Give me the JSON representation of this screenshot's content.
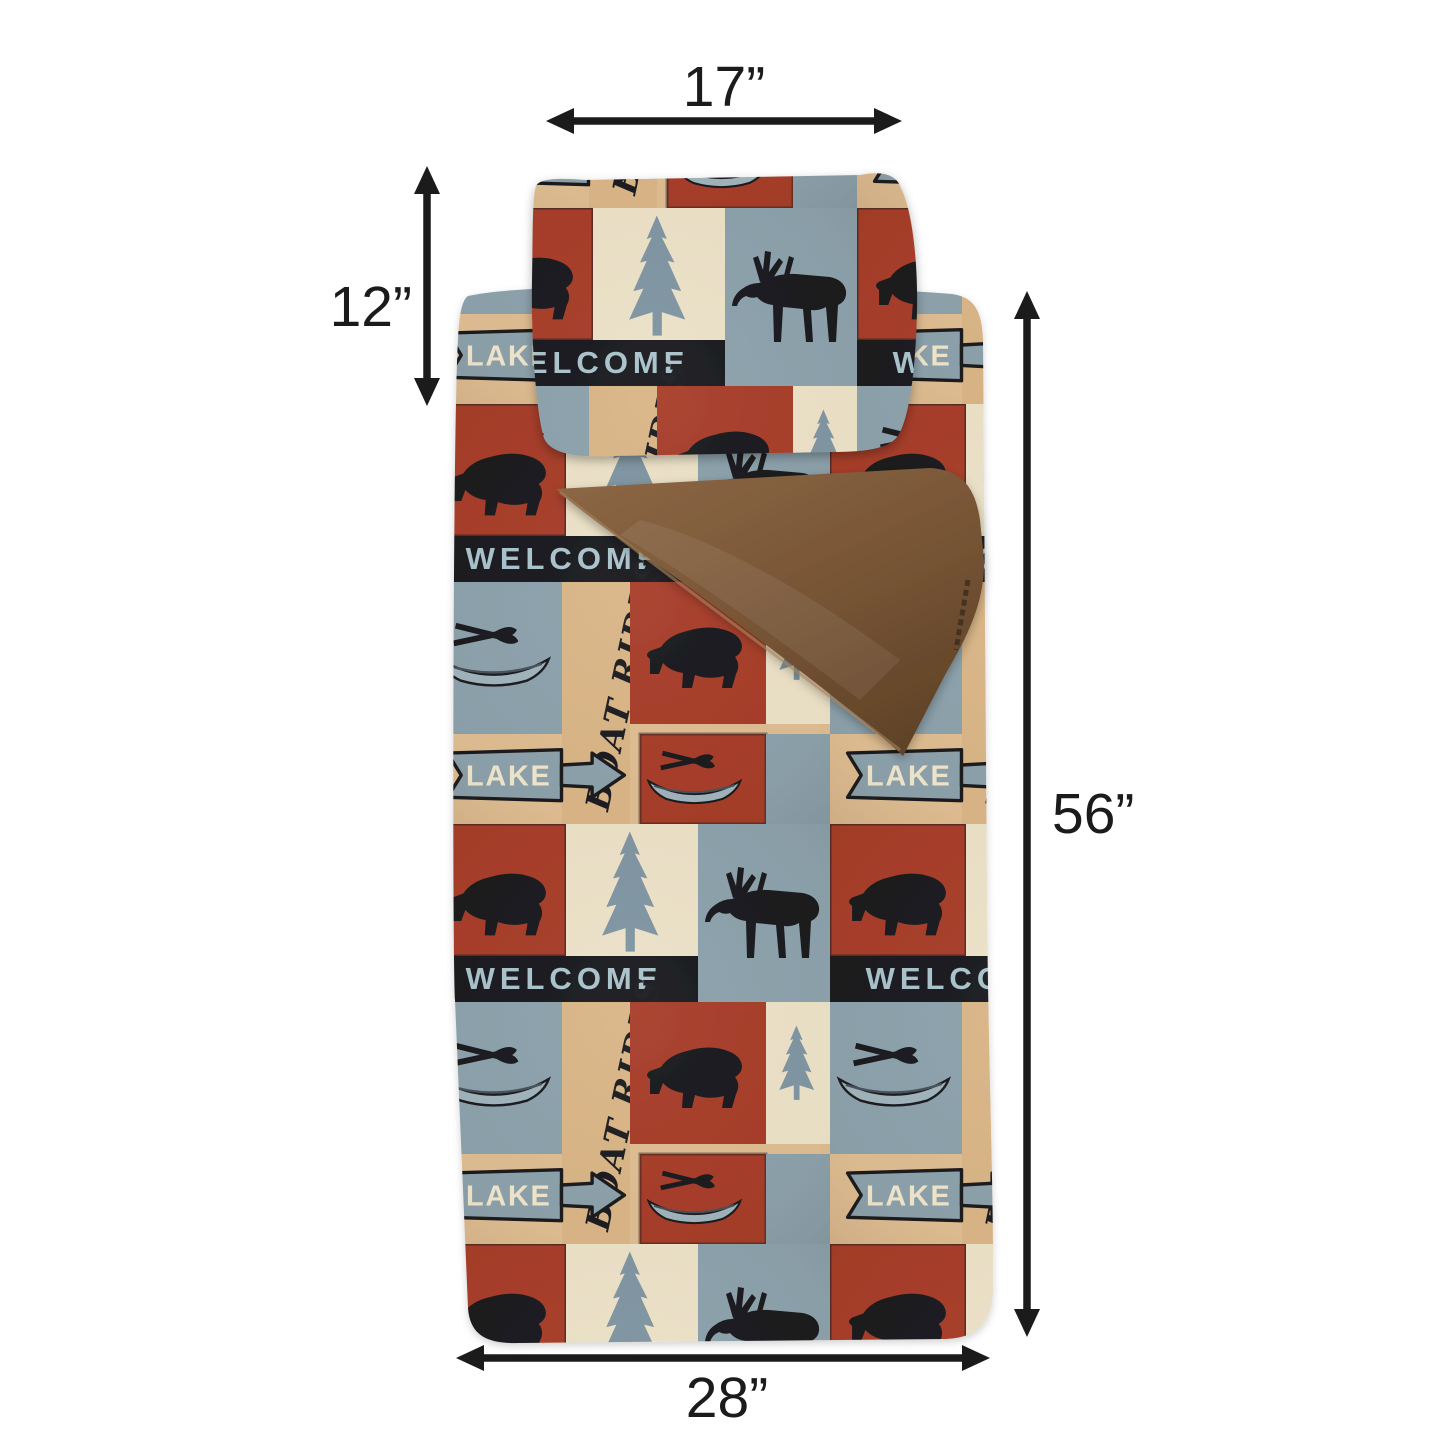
{
  "image": {
    "type": "product dimension photo",
    "background_color": "#ffffff",
    "subject": "Lake-themed plush sleeping bag with attached pillow, brown minky lining flap folded open, annotated with measurement arrows"
  },
  "dimension_annotations": {
    "pillow_width_label": "17”",
    "pillow_height_label": "12”",
    "bag_length_label": "56”",
    "bag_width_label": "28”",
    "arrow_color": "#1b1b1b"
  },
  "fabric_pattern": {
    "texts": {
      "welcome": "WELCOME",
      "lake": "LAKE",
      "boat_rides": "BOAT RIDES"
    },
    "motifs": [
      "black bear silhouette",
      "moose silhouette",
      "pine tree",
      "canoe with crossed paddles",
      "lake arrow sign",
      "welcome banner"
    ],
    "colors": {
      "red": "#a63c28",
      "blue_gray": "#8ba1ac",
      "tan": "#dfbd92",
      "cream": "#ece2c8",
      "black": "#17181d",
      "pine": "#7e95a2",
      "welcome_letters": "#a9c3cc",
      "lake_letters": "#efe6cd",
      "canoe_gray": "#9fb3bc"
    },
    "lining": {
      "brown_light": "#8a6644",
      "brown_dark": "#5e4126"
    }
  }
}
